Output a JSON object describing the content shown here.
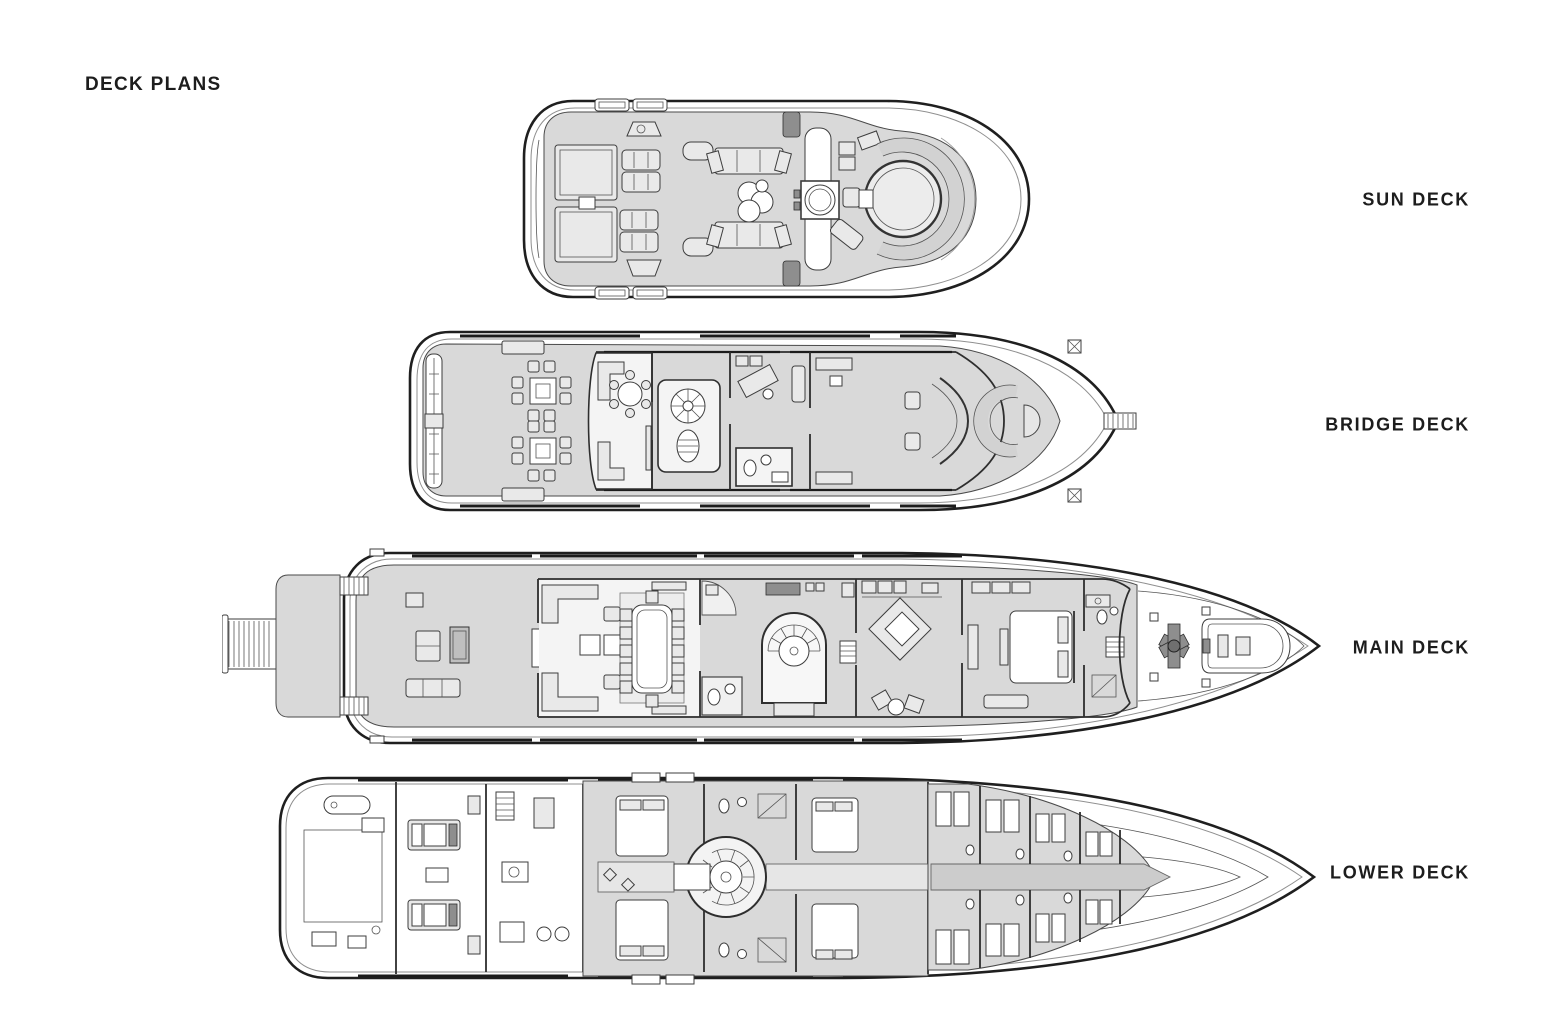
{
  "page": {
    "title": "DECK PLANS"
  },
  "colors": {
    "text": "#1d1d1d",
    "line": "#1f1f1f",
    "deck-fill": "#d9d9d9",
    "paper": "#ffffff"
  },
  "decks": [
    {
      "id": "sun-deck",
      "label": "SUN DECK"
    },
    {
      "id": "bridge-deck",
      "label": "BRIDGE DECK"
    },
    {
      "id": "main-deck",
      "label": "MAIN DECK"
    },
    {
      "id": "lower-deck",
      "label": "LOWER DECK"
    }
  ]
}
